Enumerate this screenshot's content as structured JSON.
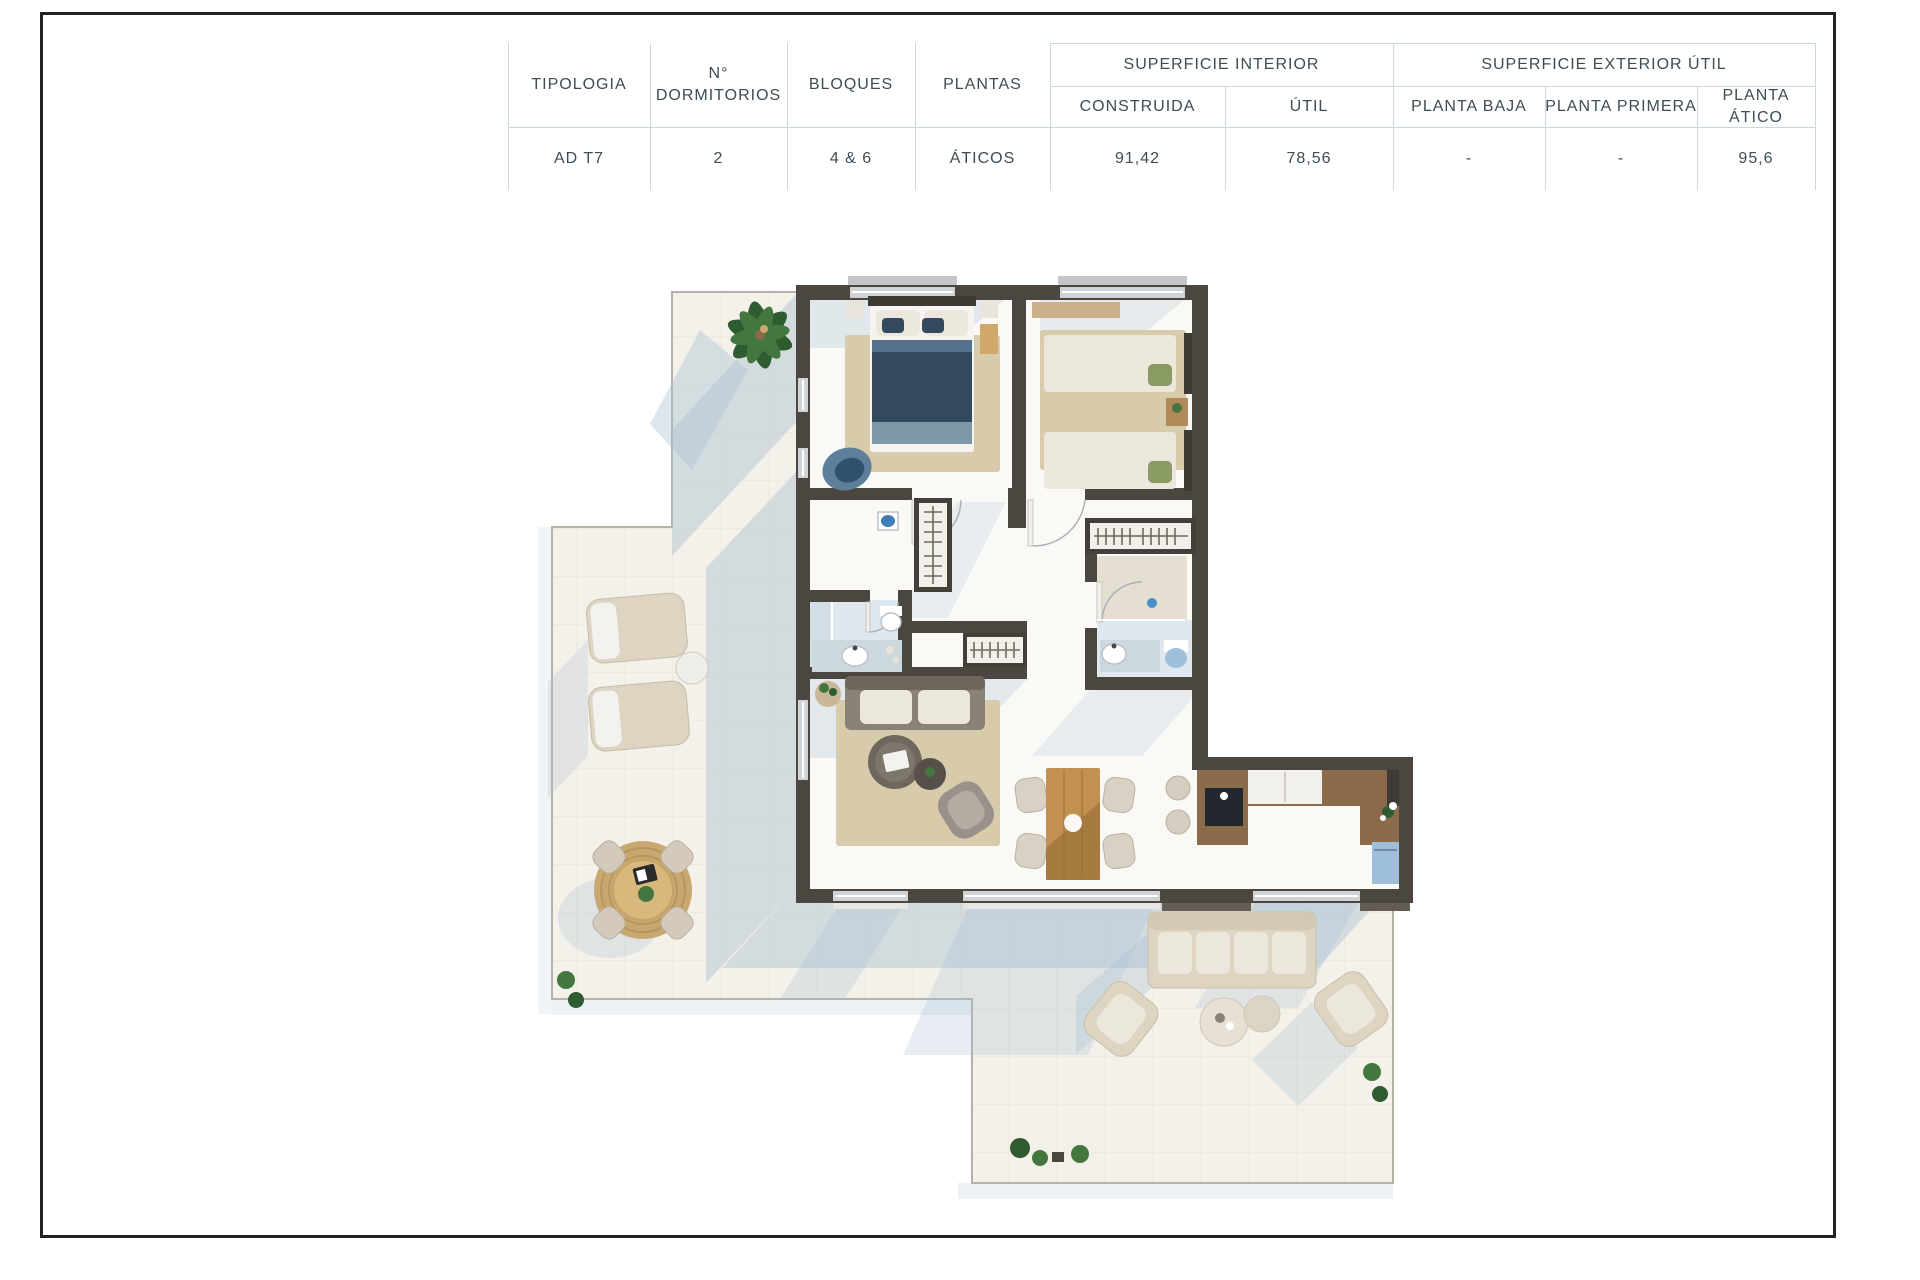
{
  "table": {
    "headers": {
      "tipologia": "TIPOLOGIA",
      "dormitorios": "N° DORMITORIOS",
      "bloques": "BLOQUES",
      "plantas": "PLANTAS"
    },
    "groups": {
      "interior": "SUPERFICIE INTERIOR",
      "exterior": "SUPERFICIE EXTERIOR ÚTIL"
    },
    "subheaders": {
      "construida": "CONSTRUIDA",
      "util": "ÚTIL",
      "baja": "PLANTA BAJA",
      "primera": "PLANTA PRIMERA",
      "atico": "PLANTA ÁTICO"
    },
    "row": {
      "tipologia": "AD T7",
      "dormitorios": "2",
      "bloques": "4 & 6",
      "plantas": "ÁTICOS",
      "construida": "91,42",
      "util": "78,56",
      "baja": "-",
      "primera": "-",
      "atico": "95,6"
    }
  },
  "floor_plan": {
    "type": "penthouse-apartment-top-view",
    "depicted_elements": [
      "palm-plant",
      "double-bed",
      "two-single-beds",
      "wardrobe-hangers",
      "bathroom-fixtures",
      "hall-closet",
      "indoor-sofa",
      "round-coffee-tables",
      "armchair",
      "wood-dining-table",
      "kitchen-counters",
      "bar-stools",
      "sun-loungers",
      "round-jute-rug-dining-set",
      "outdoor-sofa-set",
      "terrace-plants"
    ]
  },
  "colors": {
    "page_border": "#222222",
    "table_text": "#3e4c56",
    "table_grid": "#c9d7df",
    "tile": "#f4f1ea",
    "tile_line": "#e8e3d8",
    "terrace_edge": "#b6b1a8",
    "shadow": "#aac0d3",
    "wall": "#4c4641",
    "floor": "#faf9f6",
    "bath_floor": "#dfe8ee",
    "rug": "#d8cbab",
    "bed_navy": "#33495e",
    "wood": "#c3914f",
    "counter": "#8b6c4a",
    "sofa": "#8a8177",
    "outdoor_beige": "#ddd4c2",
    "jute": "#c8a770",
    "plant": "#43773f",
    "appliance_blue": "#9fbeda",
    "window": "#cfd3d6"
  }
}
